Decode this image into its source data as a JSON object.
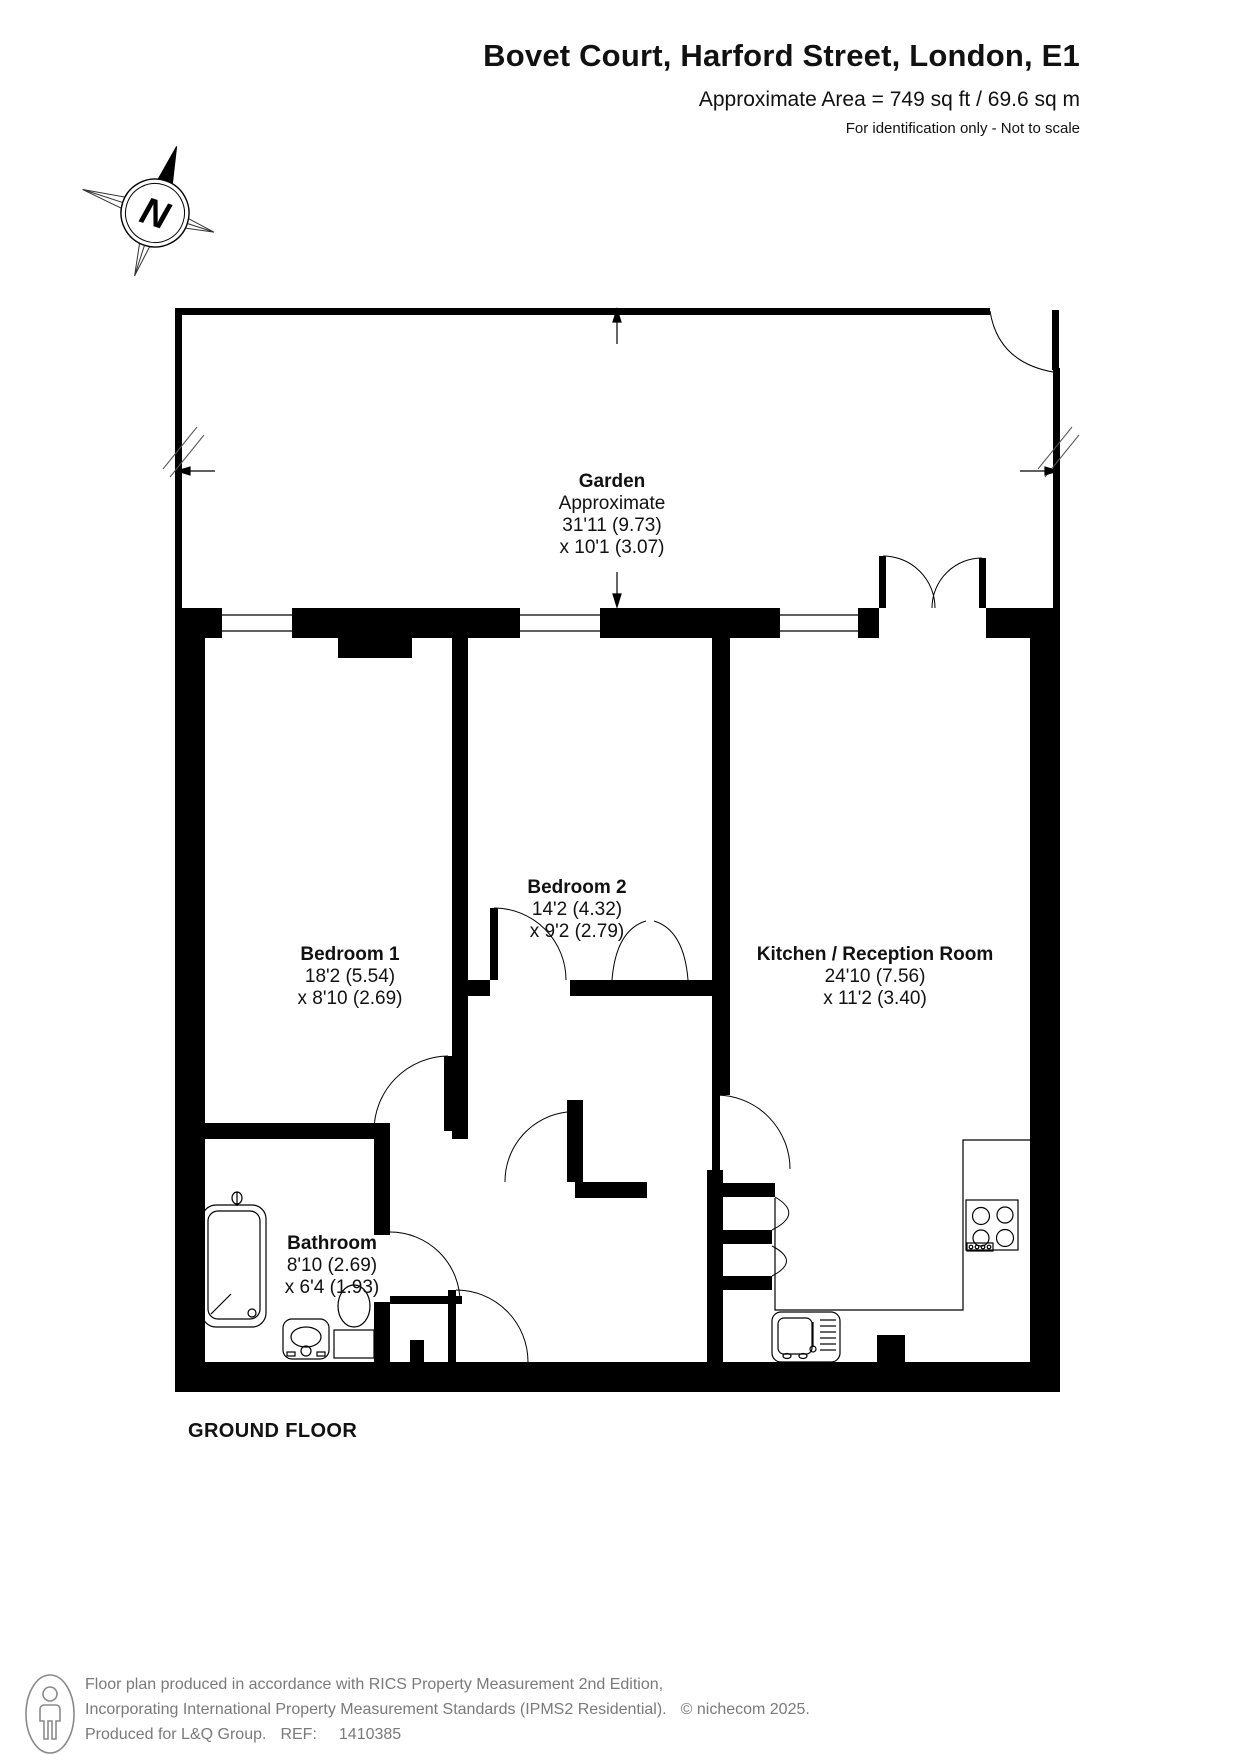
{
  "header": {
    "title": "Bovet Court, Harford Street, London, E1",
    "area_line": "Approximate Area = 749 sq ft / 69.6 sq m",
    "disclaimer": "For identification only - Not to scale"
  },
  "compass": {
    "north_label": "N"
  },
  "floor": {
    "label": "GROUND FLOOR"
  },
  "rooms": {
    "garden": {
      "name": "Garden",
      "qualifier": "Approximate",
      "dim_line1": "31'11 (9.73)",
      "dim_line2": "x 10'1 (3.07)"
    },
    "bedroom1": {
      "name": "Bedroom 1",
      "dim_line1": "18'2 (5.54)",
      "dim_line2": "x 8'10 (2.69)"
    },
    "bedroom2": {
      "name": "Bedroom 2",
      "dim_line1": "14'2 (4.32)",
      "dim_line2": "x 9'2 (2.79)"
    },
    "kitchen_reception": {
      "name": "Kitchen / Reception Room",
      "dim_line1": "24'10 (7.56)",
      "dim_line2": "x 11'2 (3.40)"
    },
    "bathroom": {
      "name": "Bathroom",
      "dim_line1": "8'10 (2.69)",
      "dim_line2": "x 6'4 (1.93)"
    }
  },
  "footer": {
    "line1": "Floor plan produced in accordance with RICS Property Measurement 2nd Edition,",
    "line2": "Incorporating International Property Measurement Standards (IPMS2 Residential).",
    "copyright": "© nichecom 2025.",
    "line3_produced": "Produced for L&Q Group.",
    "ref_label": "REF:",
    "ref_value": "1410385"
  },
  "colors": {
    "wall": "#000000",
    "text": "#111111",
    "footer_text": "#7a7a7a"
  }
}
